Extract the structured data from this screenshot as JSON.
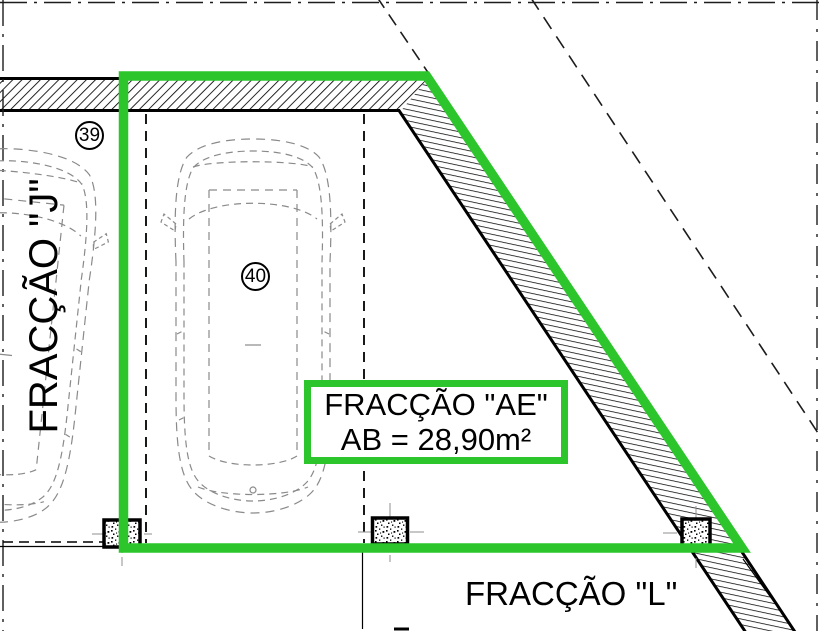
{
  "plan": {
    "space_39_label": "39",
    "space_40_label": "40",
    "fraction_j_label": "FRACÇÃO \"J\"",
    "fraction_l_label": "FRACÇÃO \"L\"",
    "highlight_box": {
      "title": "FRACÇÃO \"AE\"",
      "area": "AB = 28,90m²"
    },
    "colors": {
      "highlight_green": "#2cc62c",
      "ink": "#000000",
      "car_outline_gray": "#8a8a8a"
    }
  }
}
